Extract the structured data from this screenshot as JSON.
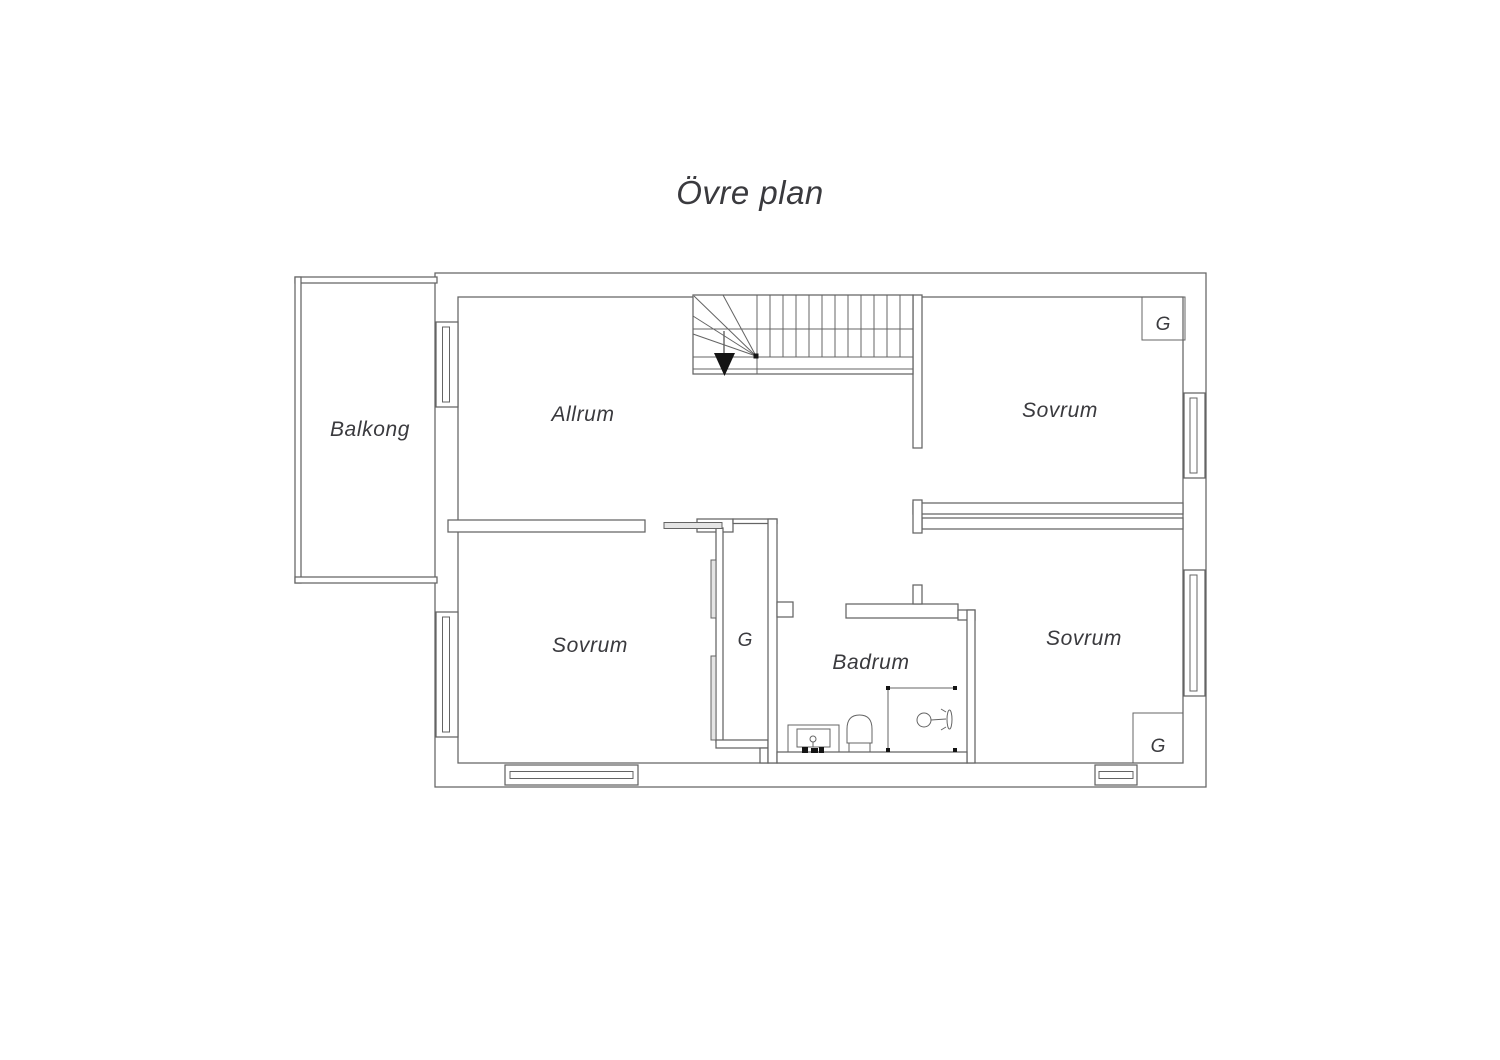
{
  "title": "Övre plan",
  "colors": {
    "line": "#646464",
    "text": "#3a3a3e",
    "arrow": "#141414"
  },
  "rooms": {
    "balcony": {
      "label": "Balkong"
    },
    "living_room": {
      "label": "Allrum"
    },
    "bedroom_top_right": {
      "label": "Sovrum"
    },
    "bedroom_bottom_left": {
      "label": "Sovrum"
    },
    "bedroom_bottom_right": {
      "label": "Sovrum"
    },
    "bathroom": {
      "label": "Badrum"
    }
  },
  "closets": {
    "walk_in": {
      "label": "G"
    },
    "top_right": {
      "label": "G"
    },
    "bottom_right": {
      "label": "G"
    }
  }
}
